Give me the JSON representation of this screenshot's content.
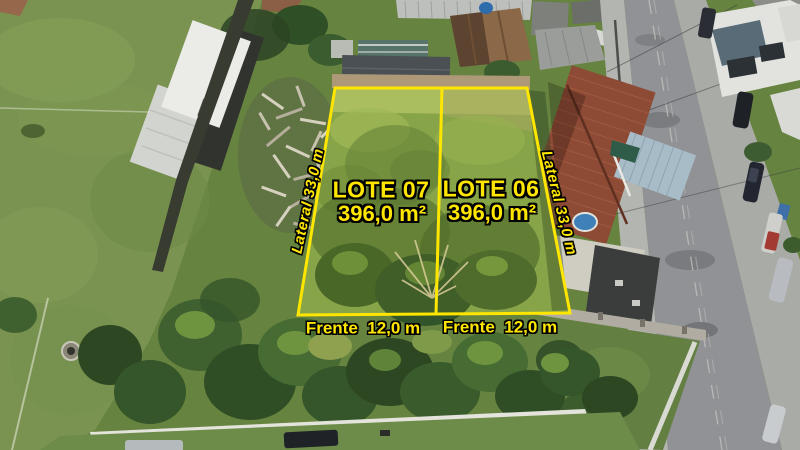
{
  "photo": {
    "description": "Aerial drone photograph of two vacant grass lots outlined in yellow, between a sports field on the left and houses and a street on the right"
  },
  "labels": {
    "lot07": {
      "title": "LOTE 07",
      "area": "396,0 m²"
    },
    "lot06": {
      "title": "LOTE 06",
      "area": "396,0 m²"
    },
    "lateral_left": "Lateral 33,0 m",
    "lateral_right": "Lateral 33,0 m",
    "frente_lot07": "Frente  12,0 m",
    "frente_lot06": "Frente  12,0 m"
  },
  "colors": {
    "annotation_yellow": "#ffe600",
    "annotation_outline": "#000000"
  }
}
